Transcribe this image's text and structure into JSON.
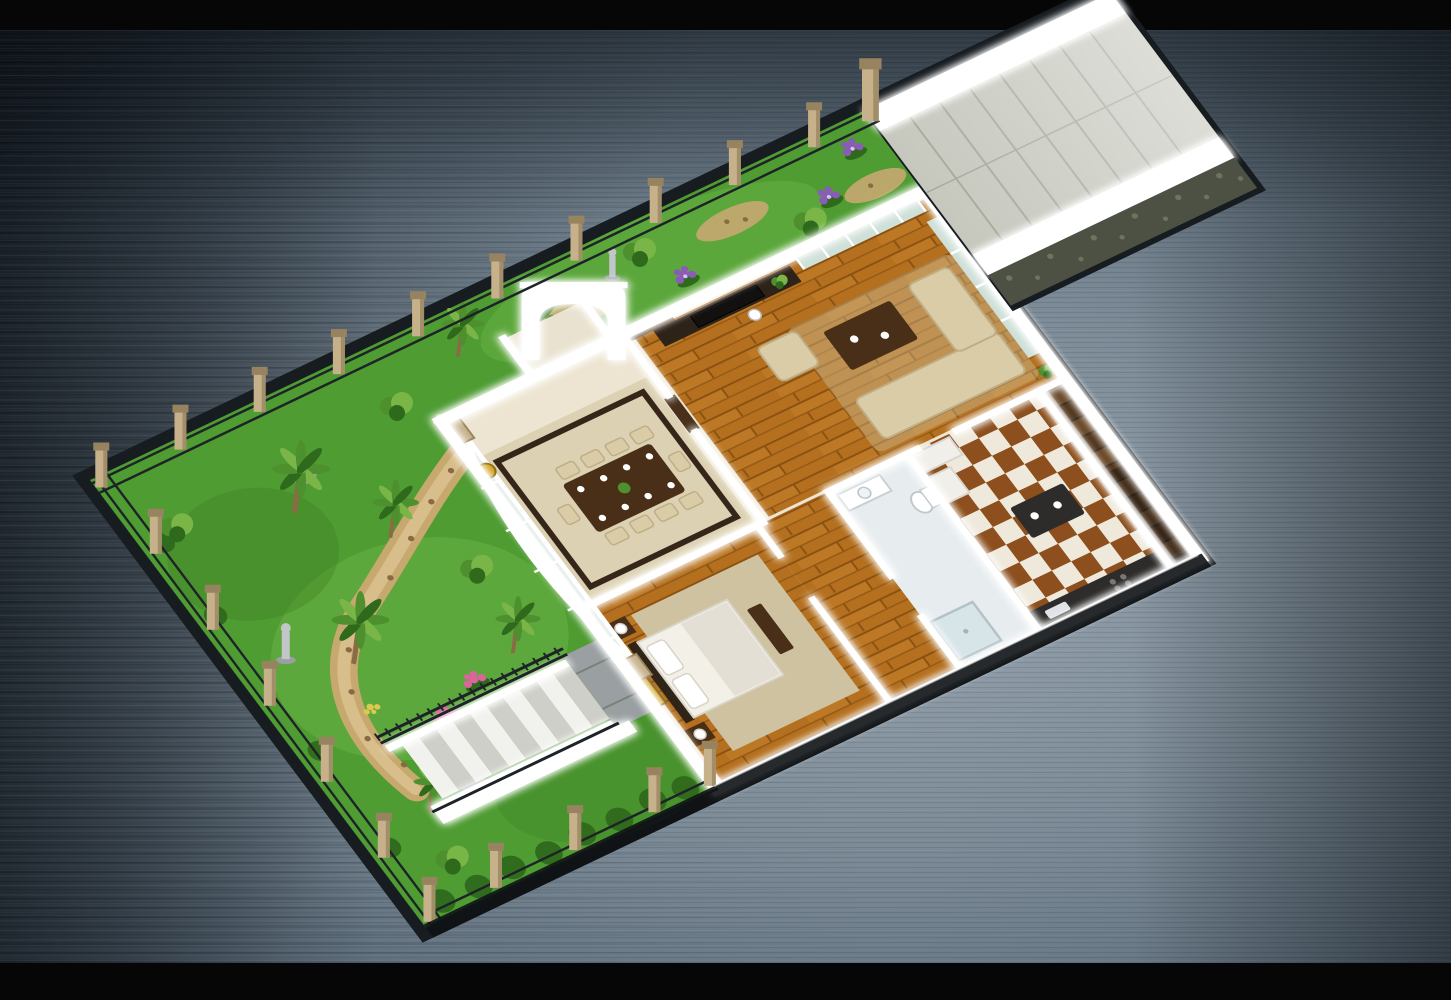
{
  "meta": {
    "domain": "architectural-3d-floor-plan",
    "description": "Aerial isometric 3D render of a single-storey house floor plan with wrap-around garden, perimeter fence and stone driveway ramp, shown on a brushed-metal blue-grey background with black letterbox bars",
    "orientation": "lot runs diagonally from lower-left to upper-right"
  },
  "palette": {
    "bar": "#060607",
    "bgLight": "#98a4af",
    "bgMid": "#5b6b79",
    "bgDark": "#2c3644",
    "grass": "#4f9c33",
    "grassLight": "#79c14e",
    "grassDark": "#37761f",
    "foliage": "#4e8f2e",
    "foliageLight": "#79b647",
    "foliageDark": "#2f6a1c",
    "trunk": "#8a6b45",
    "path": "#c7a970",
    "pathLight": "#dcc392",
    "pathDot": "#8a6a42",
    "stoneGray": "#9aa0a2",
    "statue": "#c2c6c9",
    "pink": "#d9659a",
    "purple": "#8a5cb8",
    "yellow": "#ddc94f",
    "wall": "#ffffff",
    "floorBase": "#ede5d2",
    "tile": "#dcd1b2",
    "tileBorder": "#36261a",
    "glass": "#cfe0d8",
    "wood": "#b4701f",
    "woodLight": "#cc8631",
    "woodDark": "#8a5212",
    "sofa": "#d9cca7",
    "sofaLine": "#bfae85",
    "tableWood": "#4a2f18",
    "tv": "#131110",
    "tvWall": "#2e2318",
    "door": "#49301b",
    "bedSheet": "#f3f0e8",
    "bedShadow": "#d8d3c6",
    "headboard": "#2f2418",
    "art": "#d2a21c",
    "rug": "#cfc2a0",
    "checkerA": "#8c4f1d",
    "checkerB": "#efe9dc",
    "counter": "#2d2c2a",
    "cabinet": "#f1efe9",
    "bath": "#e7edef",
    "fixture": "#ffffff",
    "stepOut": "#f1f1ee",
    "stepOutB": "#cfcfc9",
    "stepIn": "#6a4a2b",
    "stepInB": "#53381f",
    "rail": "#1d2327",
    "post": "#c6b18b",
    "postDark": "#97835f",
    "ramp": "#c6c7bd",
    "rampJoint": "#a6a79b",
    "masonry": "#4d5144",
    "masonryDot": "#6d735e",
    "edgeDark": "#101315",
    "slab": "#171c21"
  },
  "scene": {
    "background": {
      "style": "brushed metal gradient with horizontal streaks",
      "letterbox": "black bars top and bottom"
    },
    "lot": {
      "shape": "long rectangle with driveway wing at far end",
      "boundary": "tan stone pillars with dark metal railing fence"
    },
    "areas": [
      {
        "id": "front-garden",
        "features": [
          "palm trees",
          "shrubs",
          "winding pebble path",
          "pink flower bed",
          "yellow flowers",
          "garden statue",
          "rocks",
          "hedge row"
        ]
      },
      {
        "id": "back-garden-strip",
        "features": [
          "palm trees",
          "purple flower beds",
          "pebble mulch patches",
          "statue"
        ]
      },
      {
        "id": "driveway-ramp",
        "features": [
          "stone paved ramp",
          "white side walls",
          "rubble masonry base"
        ]
      },
      {
        "id": "exterior-stairs",
        "features": [
          "white steps",
          "black ornate railings",
          "stone landing",
          "white retaining wall"
        ]
      }
    ],
    "rooms": [
      {
        "id": "entrance-porch",
        "features": [
          "white arch portico",
          "dark front door"
        ]
      },
      {
        "id": "conservatory-glass-wall",
        "features": [
          "curved glazing",
          "stone pillars",
          "gold wall clock"
        ]
      },
      {
        "id": "dining-room",
        "features": [
          "dark wood table",
          "cream upholstered chairs",
          "place settings",
          "dark floor border"
        ]
      },
      {
        "id": "living-room",
        "features": [
          "hardwood plank floor",
          "cream sectional sofa",
          "armchair",
          "coffee table",
          "TV media wall",
          "window walls",
          "potted plants",
          "floor lamp"
        ]
      },
      {
        "id": "bedroom",
        "features": [
          "double bed",
          "dark headboard",
          "pillows",
          "nightstands with lamps",
          "gold wall art",
          "area rug",
          "foot bench"
        ]
      },
      {
        "id": "corridor",
        "features": [
          "hardwood floor"
        ]
      },
      {
        "id": "bathroom",
        "features": [
          "vanity",
          "toilet",
          "shower"
        ]
      },
      {
        "id": "kitchen",
        "features": [
          "checkerboard tile floor",
          "dark counters",
          "island",
          "cabinets",
          "refrigerator"
        ]
      },
      {
        "id": "interior-stairs",
        "features": [
          "dark wood steps",
          "white stringers"
        ]
      }
    ]
  }
}
